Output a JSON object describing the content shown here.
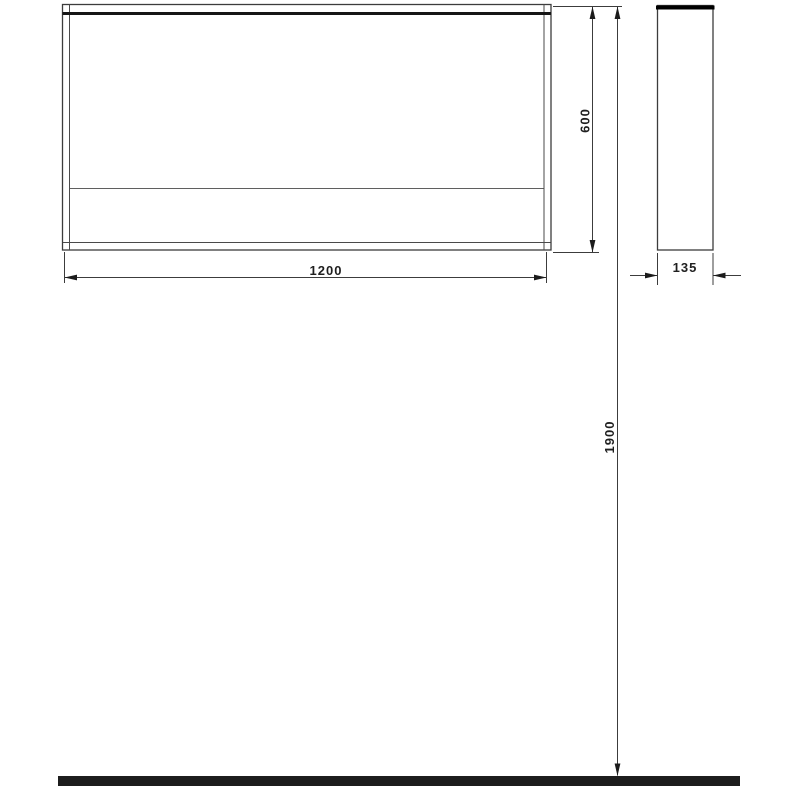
{
  "colors": {
    "background": "#ffffff",
    "line": "#3c3c3c",
    "heavy_line": "#161616",
    "floor": "#1d1d1d",
    "text": "#1f1f1f"
  },
  "dimensions": {
    "width": "1200",
    "height": "600",
    "depth": "135",
    "installation_height": "1900"
  }
}
